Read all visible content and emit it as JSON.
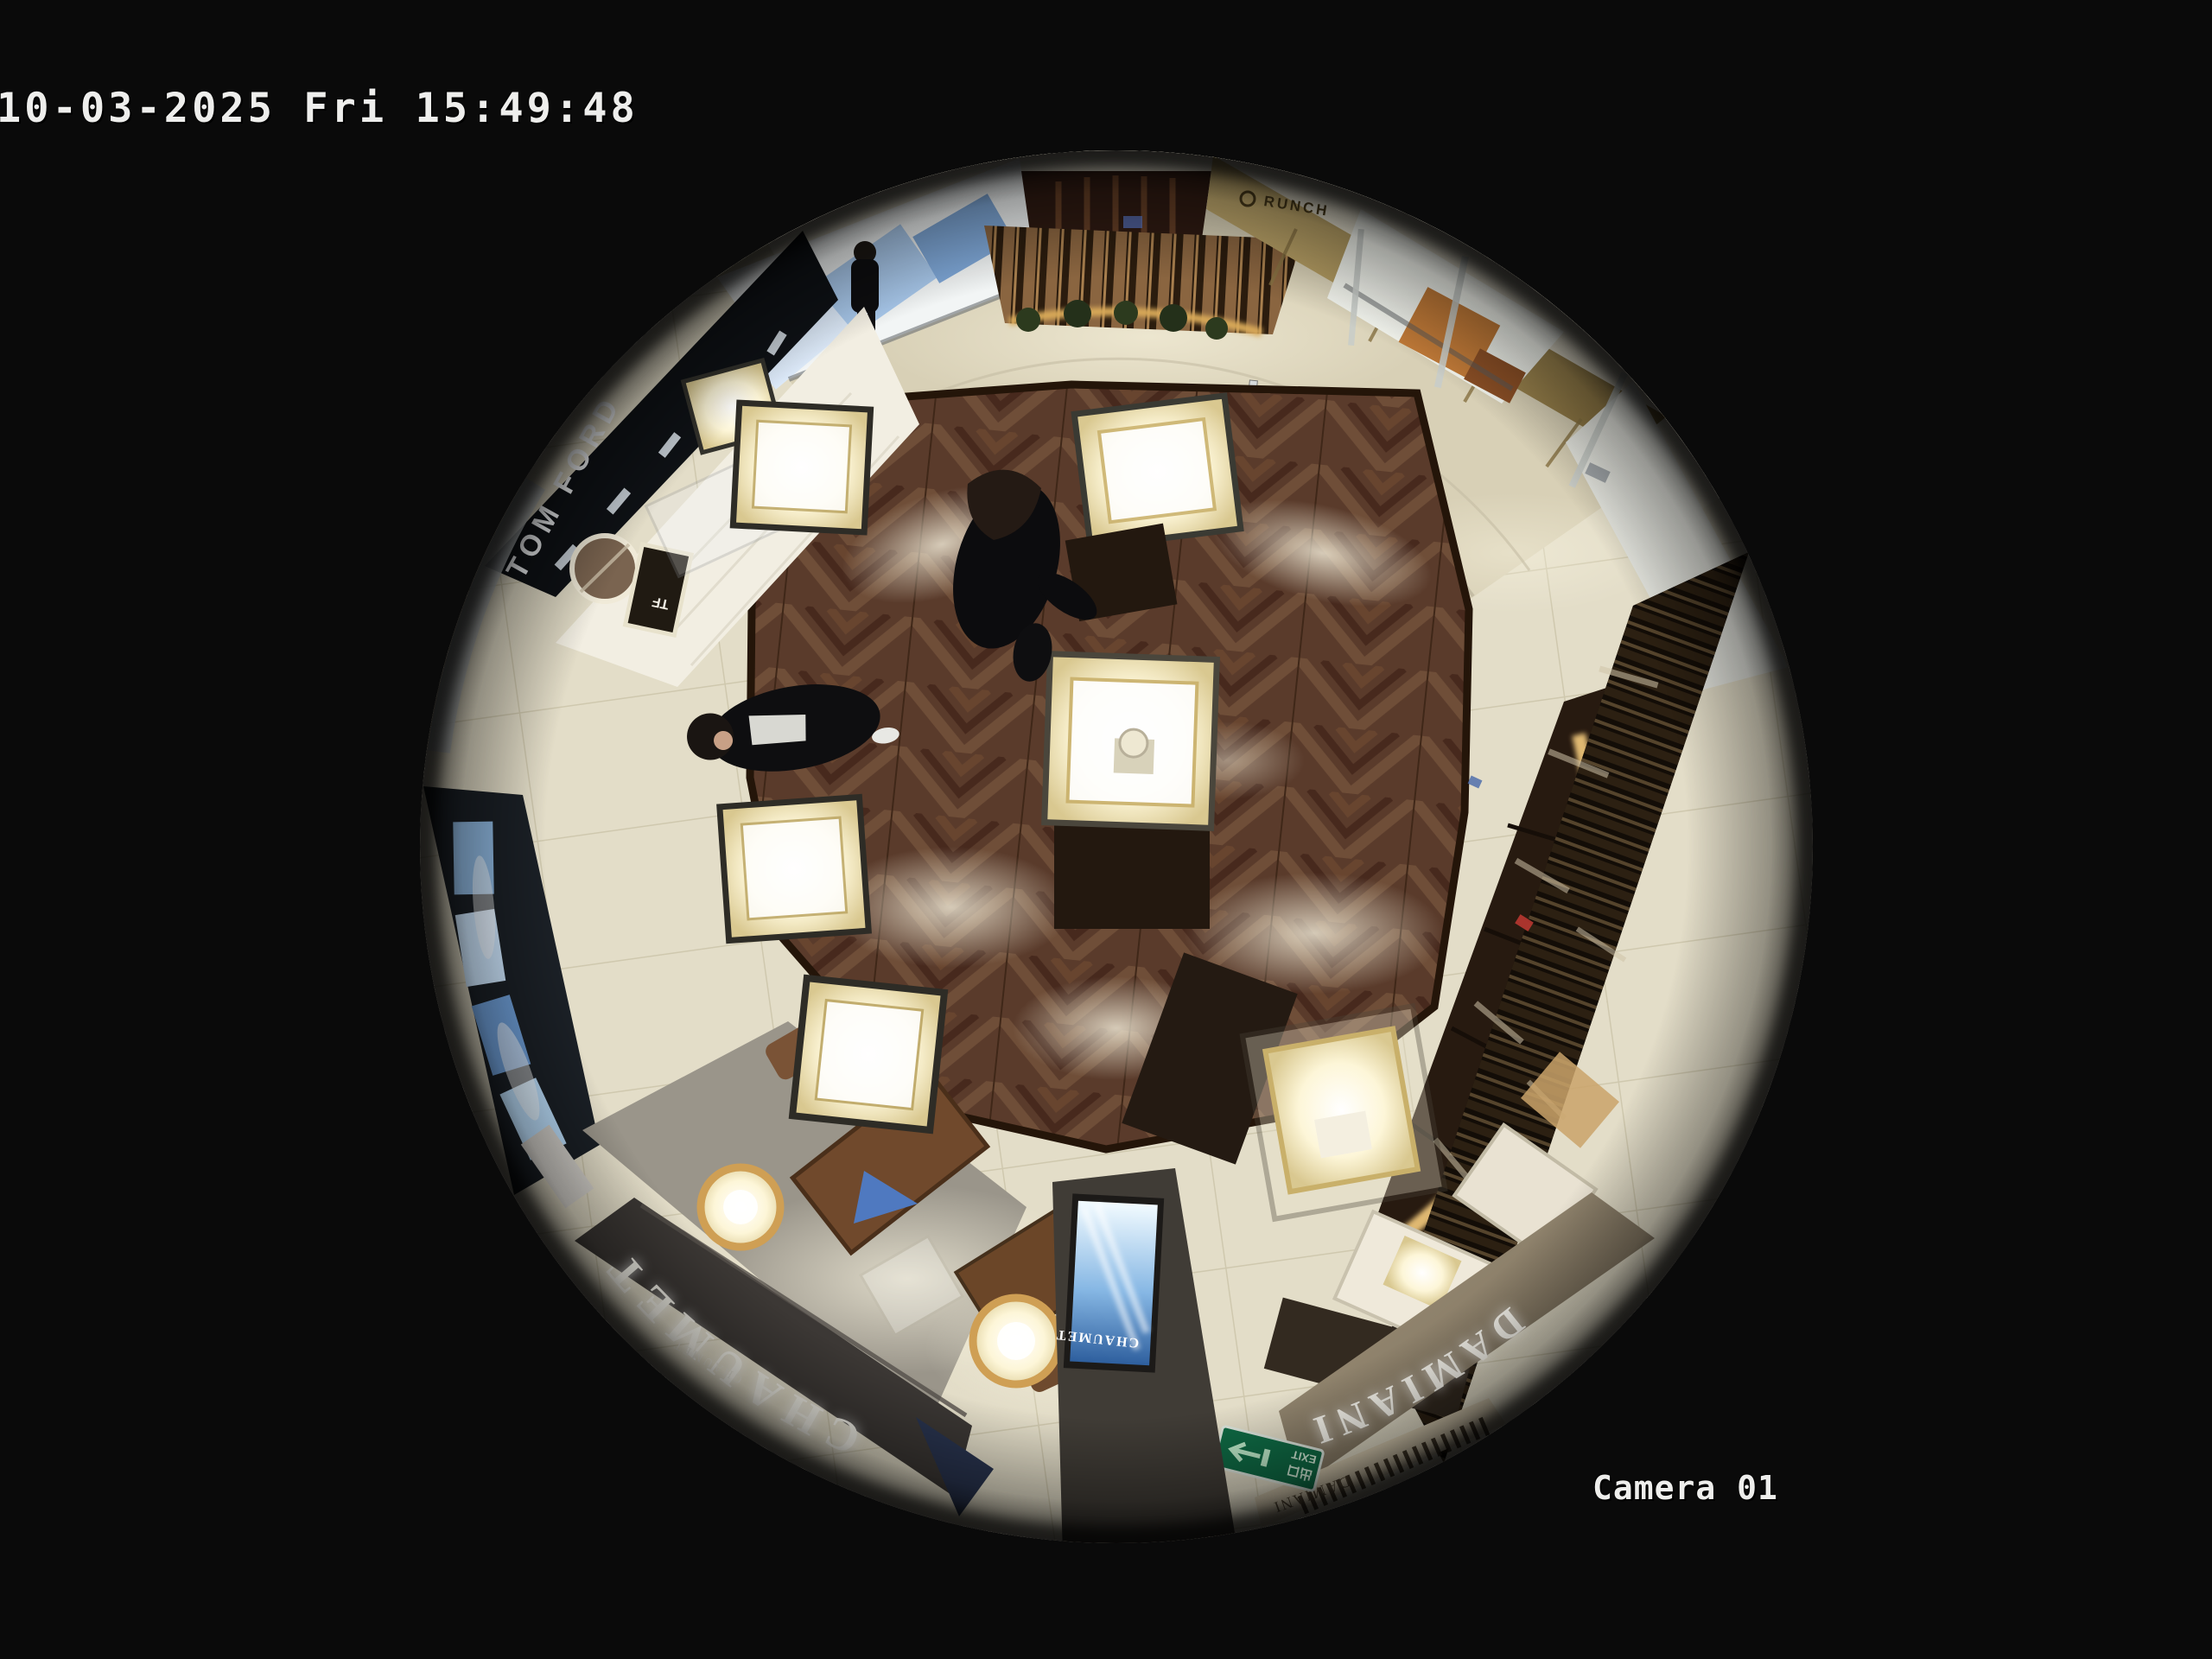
{
  "overlay": {
    "timestamp": "10-03-2025 Fri 15:49:48",
    "camera_label": "Camera 01",
    "osd_text_color": "#eeeeec"
  },
  "scene": {
    "signs": {
      "chaumet_storefront": "CHAUMET",
      "chaumet_storefront_small": "CHAUMET",
      "damiani_storefront": "DAMIANI",
      "damiani_fascia_small": "DAMIANI",
      "tom_ford_fascia": "TOM FORD",
      "tf_display": "TF",
      "chaumet_ad_screen": "CHAUMET",
      "exit_sign_cn": "出口",
      "exit_sign_en": "EXIT",
      "gold_fascia_sign": "RUNCH"
    },
    "colors": {
      "background": "#0a0a0a",
      "sign_white": "#f7f5ec",
      "exit_green": "#0f6b45",
      "ad_screen_blue": "#9cc6e8",
      "brass_gold": "#d8a958",
      "wood_floor": "#5a3b2b",
      "tile_floor": "#e3ddc8"
    }
  }
}
